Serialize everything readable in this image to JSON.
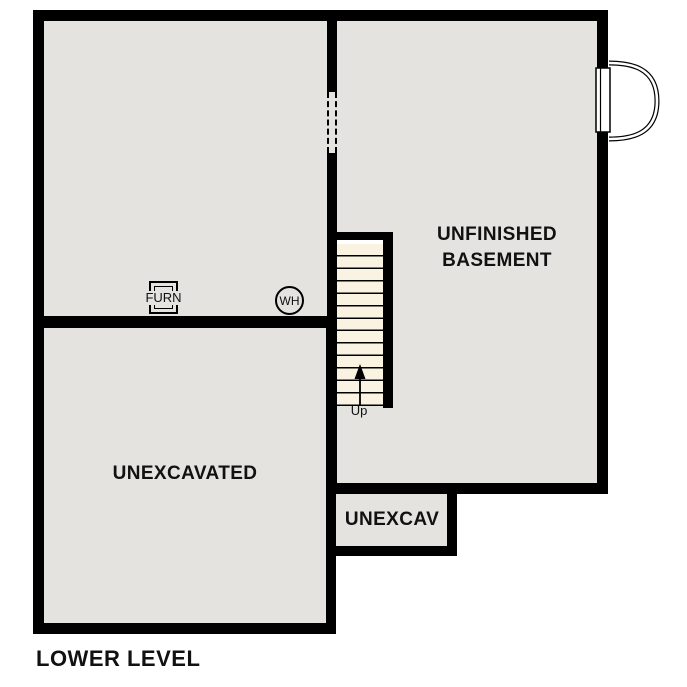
{
  "page": {
    "title": "LOWER LEVEL"
  },
  "rooms": {
    "unfinished_basement": {
      "name_line1": "UNFINISHED",
      "name_line2": "BASEMENT"
    },
    "unexcavated": {
      "name": "UNEXCAVATED"
    },
    "unexcav": {
      "name": "UNEXCAV"
    }
  },
  "fixtures": {
    "furnace_label": "FURN",
    "water_heater_label": "WH"
  },
  "stairs": {
    "direction_label": "Up",
    "tread_count": 13
  },
  "colors": {
    "wall": "#000000",
    "room_fill": "#e5e3e0",
    "stair_fill": "#faf3e2",
    "background": "#ffffff"
  }
}
